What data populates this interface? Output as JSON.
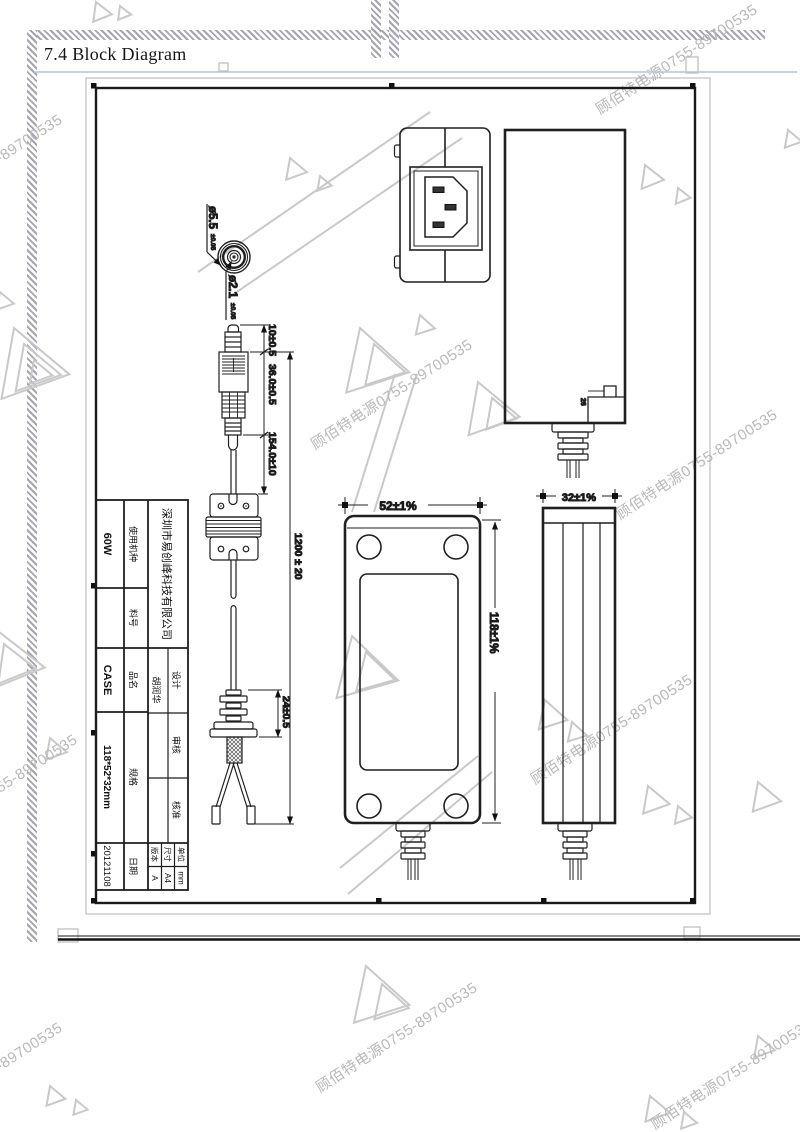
{
  "page": {
    "heading": "7.4 Block Diagram"
  },
  "watermark": {
    "text": "顾佰特电源0755-89700535"
  },
  "dc_plug_front": {
    "outer_diameter": "ø5.5",
    "outer_tolerance": "±0.05",
    "inner_diameter": "ø2.1",
    "inner_tolerance": "±0.05"
  },
  "dc_cord": {
    "tip_length": "10±0.5",
    "plug_body_length": "36.0±0.5",
    "plug_to_ferrite": "154.0±10",
    "overall_length": "1200 ± 20",
    "strain_relief_length": "24±0.5"
  },
  "adapter": {
    "width": "52±1%",
    "length": "118±1%",
    "thickness": "32±1%",
    "notch_detail": "26"
  },
  "title_block": {
    "company": "深圳市易创峰科技有限公司",
    "usage_label": "使用机种",
    "usage_value": "60W",
    "part_label": "料号",
    "part_value": "",
    "product_label": "品名",
    "product_value": "CASE",
    "spec_label": "规格",
    "spec_value": "118*52*32mm",
    "date_label": "日期",
    "date_value": "20121108",
    "design_label": "设计",
    "designer": "胡润华",
    "review_label": "审核",
    "review_value": "",
    "approve_label": "核准",
    "approve_value": "",
    "unit_label": "单位",
    "unit_value": "mm",
    "sheet_label": "尺寸",
    "sheet_value": "A4",
    "rev_label": "版本",
    "rev_value": "A"
  }
}
